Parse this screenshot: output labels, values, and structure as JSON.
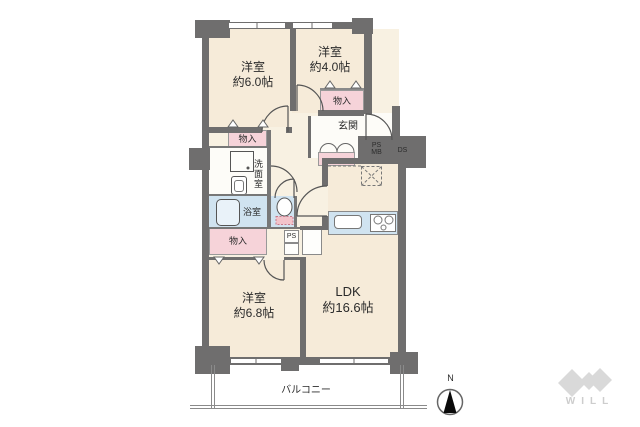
{
  "floorplan": {
    "rooms": {
      "west6": {
        "name": "洋室",
        "size": "約6.0帖"
      },
      "west4": {
        "name": "洋室",
        "size": "約4.0帖"
      },
      "west68": {
        "name": "洋室",
        "size": "約6.8帖"
      },
      "ldk": {
        "name": "LDK",
        "size": "約16.6帖"
      }
    },
    "labels": {
      "storage": "物入",
      "entrance": "玄関",
      "washroom": "洗面室",
      "bathroom": "浴室",
      "ps": "PS",
      "mb": "MB",
      "ds": "DS",
      "ps_small": "PS",
      "balcony": "バルコニー",
      "north": "N",
      "logo_text": "WILL"
    },
    "colors": {
      "wall": "#6f6e6e",
      "room_floor": "#f6ebd9",
      "corridor_floor": "#f8f1e2",
      "storage_fill": "#f6d3d9",
      "wet_area_fill": "#d0e3f0",
      "logo_gray": "#d9d9d9",
      "background": "#ffffff"
    }
  }
}
